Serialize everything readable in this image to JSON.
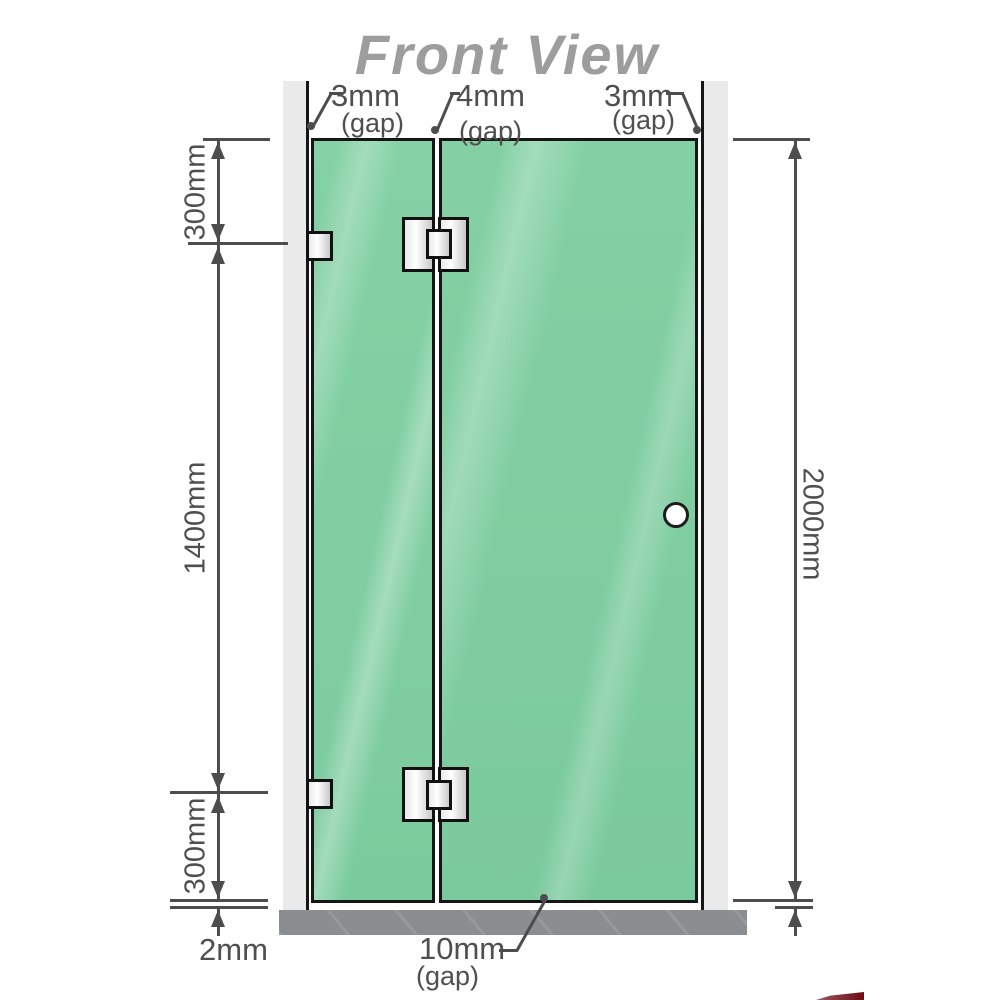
{
  "title": "Front View",
  "top_gaps": [
    {
      "value": "3mm",
      "suffix": "(gap)"
    },
    {
      "value": "4mm",
      "suffix": "(gap)"
    },
    {
      "value": "3mm",
      "suffix": "(gap)"
    }
  ],
  "dimensions": {
    "left_top": "300mm",
    "left_middle": "1400mm",
    "left_bottom": "300mm",
    "right_total": "2000mm",
    "base_thickness": "2mm",
    "bottom_gap": {
      "value": "10mm",
      "suffix": "(gap)"
    }
  },
  "colors": {
    "glass": "#82cfa2",
    "wall": "#eaeaea",
    "base": "#8b8e91",
    "dimension_line": "#4d4d4d",
    "label_text": "#4f4f4f",
    "title_text": "#9d9d9d",
    "hardware_border": "#111111",
    "handle_fill": "#ffffff",
    "watermark": "#6f0a18"
  }
}
